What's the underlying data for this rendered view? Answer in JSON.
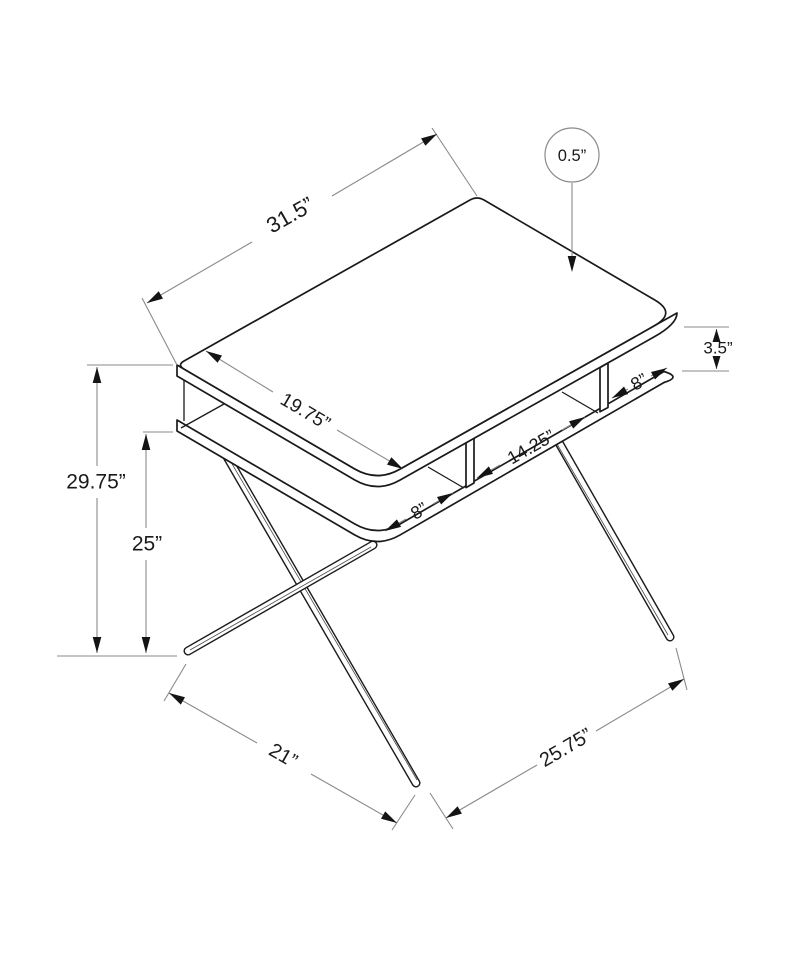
{
  "diagram": {
    "labels": {
      "top_width": "31.5”",
      "top_thickness": "0.5”",
      "cubby_height": "3.5”",
      "top_depth": "19.75”",
      "cubby_left_width": "8”",
      "cubby_middle_width": "14.25”",
      "cubby_right_width": "8”",
      "overall_height": "29.75”",
      "leg_clearance_height": "25”",
      "side_foot_span": "21”",
      "front_foot_span": "25.75”"
    },
    "colors": {
      "background": "#ffffff",
      "outline": "#1a1a1a",
      "dimension": "#8a8a8a",
      "arrow": "#141414",
      "text": "#1a1a1a"
    }
  }
}
